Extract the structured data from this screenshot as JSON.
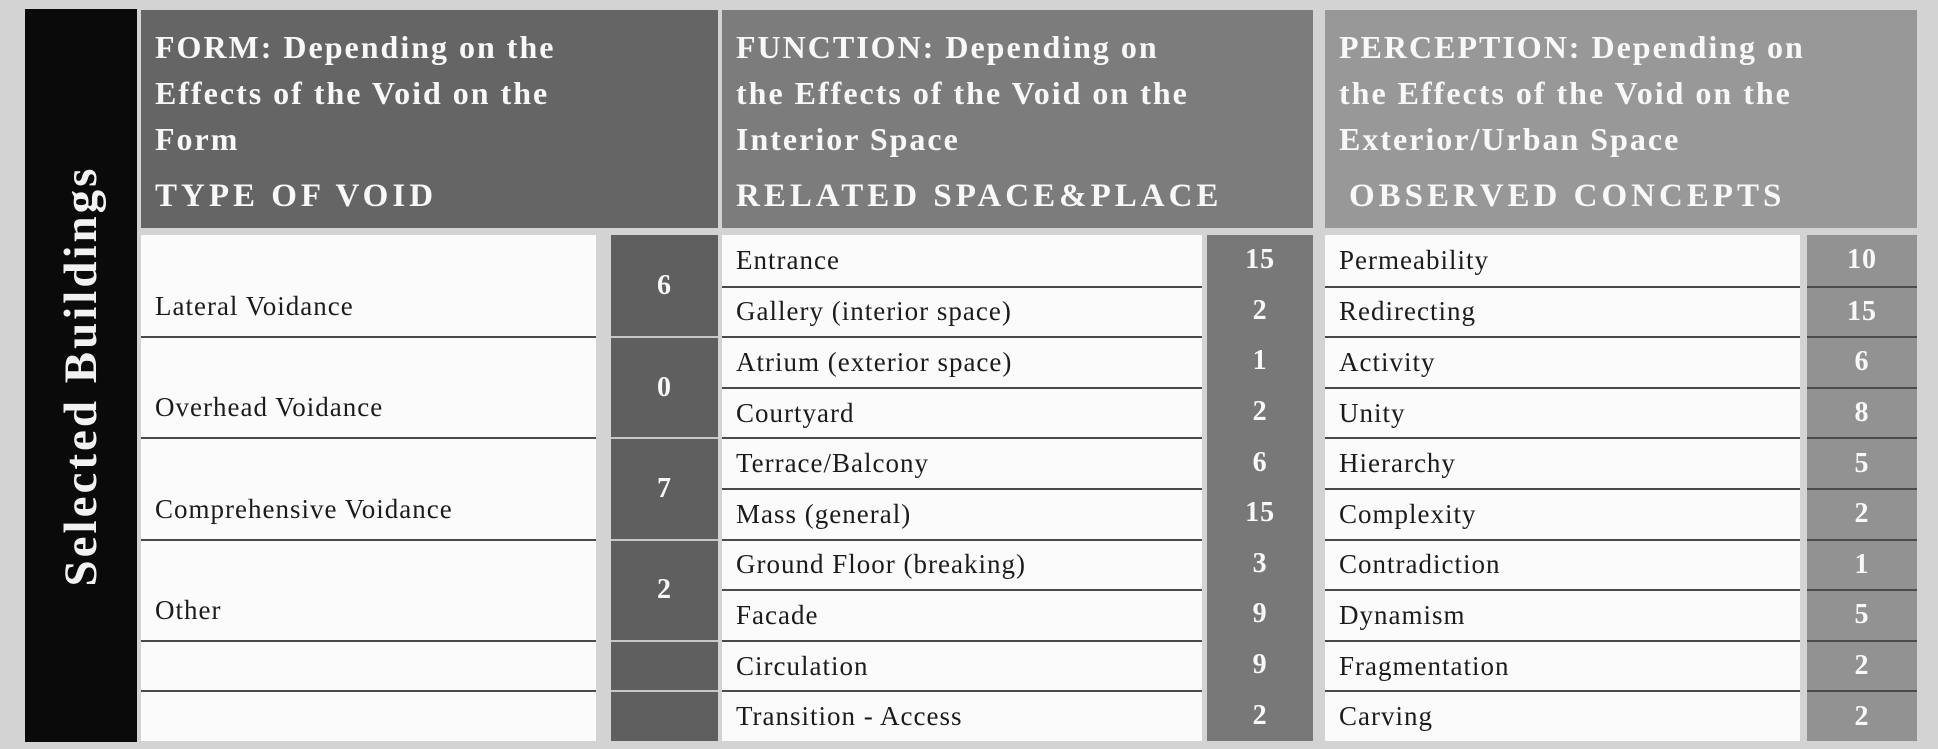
{
  "sidebar": {
    "label": "Selected Buildings"
  },
  "columns": [
    {
      "title_lines": [
        "FORM: Depending on the",
        "Effects of the Void on the",
        "Form"
      ],
      "subtitle": "TYPE OF VOID",
      "rows": [
        {
          "label": "Lateral Voidance",
          "value": "6"
        },
        {
          "label": "Overhead Voidance",
          "value": "0"
        },
        {
          "label": "Comprehensive Voidance",
          "value": "7"
        },
        {
          "label": "Other",
          "value": "2"
        },
        {
          "label": "",
          "value": ""
        },
        {
          "label": "",
          "value": ""
        }
      ]
    },
    {
      "title_lines": [
        "FUNCTION: Depending on",
        "the Effects of the Void on the",
        "Interior Space"
      ],
      "subtitle": "RELATED SPACE&PLACE",
      "rows": [
        {
          "label": "Entrance",
          "value": "15"
        },
        {
          "label": "Gallery (interior space)",
          "value": "2"
        },
        {
          "label": "Atrium (exterior space)",
          "value": "1"
        },
        {
          "label": "Courtyard",
          "value": "2"
        },
        {
          "label": "Terrace/Balcony",
          "value": "6"
        },
        {
          "label": "Mass (general)",
          "value": "15"
        },
        {
          "label": "Ground Floor (breaking)",
          "value": "3"
        },
        {
          "label": "Facade",
          "value": "9"
        },
        {
          "label": "Circulation",
          "value": "9"
        },
        {
          "label": "Transition - Access",
          "value": "2"
        }
      ]
    },
    {
      "title_lines": [
        "PERCEPTION: Depending on",
        "the Effects of the Void on the",
        "Exterior/Urban Space"
      ],
      "subtitle": "OBSERVED CONCEPTS",
      "rows": [
        {
          "label": "Permeability",
          "value": "10"
        },
        {
          "label": "Redirecting",
          "value": "15"
        },
        {
          "label": "Activity",
          "value": "6"
        },
        {
          "label": "Unity",
          "value": "8"
        },
        {
          "label": "Hierarchy",
          "value": "5"
        },
        {
          "label": "Complexity",
          "value": "2"
        },
        {
          "label": "Contradiction",
          "value": "1"
        },
        {
          "label": "Dynamism",
          "value": "5"
        },
        {
          "label": "Fragmentation",
          "value": "2"
        },
        {
          "label": "Carving",
          "value": "2"
        }
      ]
    }
  ],
  "colors": {
    "page_bg": "#d3d3d3",
    "sidebar_bg": "#0a0a0a",
    "form_header_bg": "#656565",
    "form_value_cell_bg": "#5f5f5f",
    "function_header_bg": "#7c7c7c",
    "function_value_strip_bg": "#787878",
    "perception_header_bg": "#989898",
    "perception_value_cell_bg": "#929292",
    "label_cell_bg": "#fbfbfb",
    "row_line": "#4a4a4a",
    "header_text": "#f8f8f8",
    "label_text": "#1b1b1b"
  },
  "chart_data": [
    {
      "type": "table",
      "title": "FORM: Depending on the Effects of the Void on the Form",
      "subtitle": "TYPE OF VOID",
      "row_header": "Selected Buildings",
      "categories": [
        "Lateral Voidance",
        "Overhead Voidance",
        "Comprehensive Voidance",
        "Other"
      ],
      "values": [
        6,
        0,
        7,
        2
      ]
    },
    {
      "type": "table",
      "title": "FUNCTION: Depending on the Effects of the Void on the Interior Space",
      "subtitle": "RELATED SPACE&PLACE",
      "row_header": "Selected Buildings",
      "categories": [
        "Entrance",
        "Gallery (interior space)",
        "Atrium (exterior space)",
        "Courtyard",
        "Terrace/Balcony",
        "Mass (general)",
        "Ground Floor (breaking)",
        "Facade",
        "Circulation",
        "Transition - Access"
      ],
      "values": [
        15,
        2,
        1,
        2,
        6,
        15,
        3,
        9,
        9,
        2
      ]
    },
    {
      "type": "table",
      "title": "PERCEPTION: Depending on the Effects of the Void on the Exterior/Urban Space",
      "subtitle": "OBSERVED CONCEPTS",
      "row_header": "Selected Buildings",
      "categories": [
        "Permeability",
        "Redirecting",
        "Activity",
        "Unity",
        "Hierarchy",
        "Complexity",
        "Contradiction",
        "Dynamism",
        "Fragmentation",
        "Carving"
      ],
      "values": [
        10,
        15,
        6,
        8,
        5,
        2,
        1,
        5,
        2,
        2
      ]
    }
  ]
}
